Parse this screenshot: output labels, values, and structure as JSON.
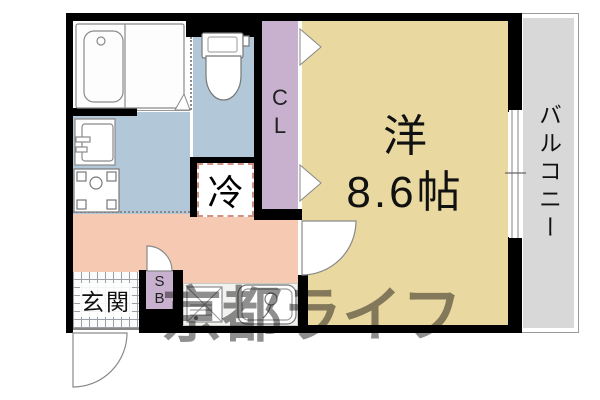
{
  "colors": {
    "wall": "#000000",
    "main-room": "#e9d8a0",
    "wet-area": "#b2c8d8",
    "closet": "#c7b1ce",
    "hall": "#f6c9b2",
    "balcony": "#d8d8d8",
    "fridge-dash": "#cf9181",
    "watermark": "#8f8f8f"
  },
  "labels": {
    "main_room_type": "洋",
    "main_room_size": "8.6帖",
    "balcony": "バルコニー",
    "closet_line1": "C",
    "closet_line2": "L",
    "refrigerator": "冷",
    "entrance": "玄関",
    "shoebox_line1": "S",
    "shoebox_line2": "B"
  },
  "watermark": {
    "text": "京都ライフ"
  },
  "fixtures": [
    "bathtub-icon",
    "toilet-icon",
    "washbasin-icon",
    "washing-machine-pan-icon",
    "gas-stove-icon",
    "kitchen-sink-icon",
    "sliding-window-icon",
    "entrance-door-arc-icon",
    "room-door-arc-icon",
    "hall-door-arc-icon",
    "closet-folding-door-icon",
    "bathroom-door-icon"
  ]
}
